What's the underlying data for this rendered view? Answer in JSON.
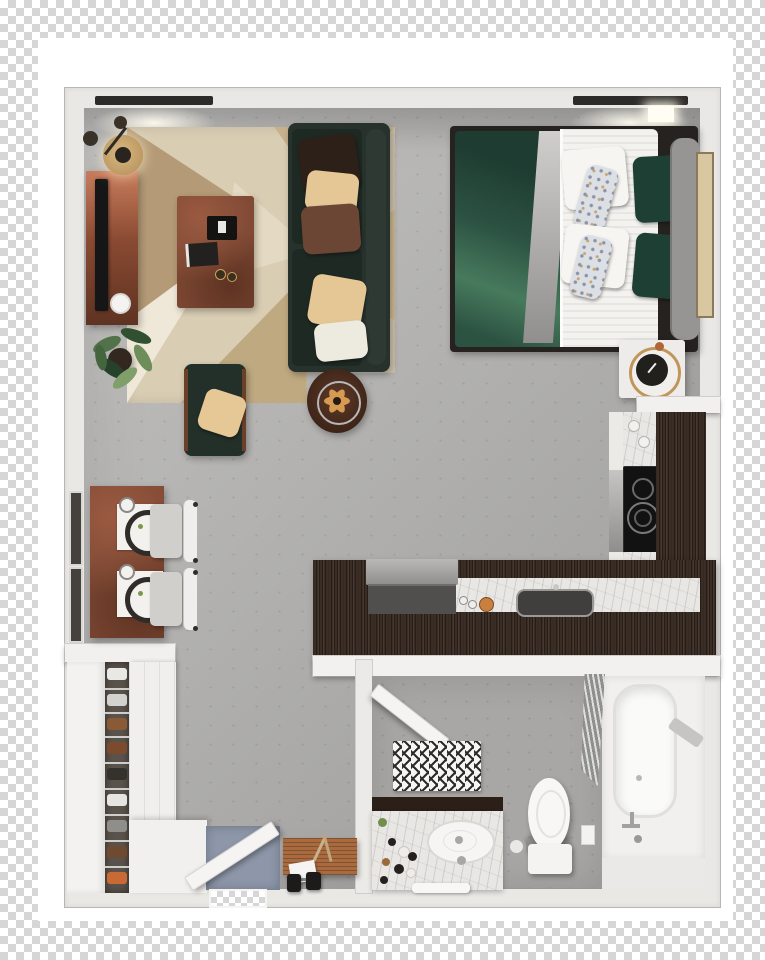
{
  "scene": {
    "kind": "3d-floor-plan-top-view",
    "subject": "studio-apartment-render",
    "background": "transparency-checkerboard",
    "visible_text": ""
  },
  "palette": {
    "checker_gray": "#d6d6d6",
    "photo_background": "#ffffff",
    "wall": "#e9e8e5",
    "floor_concrete": "#aeadab",
    "rug_base": "#d9cdb4",
    "rug_triangle_dark": "#b49a76",
    "sofa_green_black": "#27322d",
    "duvet_green": "#2c5242",
    "pillow_tan": "#e2c795",
    "pillow_rust": "#6c4634",
    "accent_rust_wood": "#7c4733",
    "kitchen_dark_wood": "#3b2d24",
    "marble": "#e9e7e3",
    "cooktop_black": "#121212",
    "entry_mat_blue": "#8d97a9",
    "clock_gold": "#c0965a",
    "bench_wood": "#a86a3e"
  },
  "rooms": {
    "living": {
      "label": "living-area",
      "items": [
        "floor-lamp",
        "tv-console",
        "television",
        "area-rug",
        "coffee-table",
        "sofa",
        "throw-pillows",
        "armchair",
        "side-table",
        "potted-plant"
      ]
    },
    "sleeping": {
      "label": "sleeping-area",
      "items": [
        "double-bed",
        "green-duvet",
        "gray-throw",
        "bed-pillows",
        "headboard",
        "wall-art",
        "nightstand",
        "table-clock"
      ]
    },
    "dining": {
      "label": "dining-nook",
      "items": [
        "dining-table",
        "place-settings",
        "dining-chairs",
        "windows"
      ]
    },
    "kitchen": {
      "label": "kitchen",
      "items": [
        "l-shaped-counter",
        "cooktop",
        "oven",
        "kitchen-sink",
        "copper-pot",
        "countertop-appliance"
      ]
    },
    "bathroom": {
      "label": "bathroom",
      "items": [
        "bathroom-door",
        "bath-mat",
        "toilet",
        "vanity",
        "vanity-sink",
        "shower-curtain",
        "bathtub",
        "tub-faucet"
      ]
    },
    "entry": {
      "label": "entry-closet",
      "items": [
        "shoe-shelf",
        "closet-door",
        "wardrobe",
        "entry-door",
        "door-mat",
        "bench",
        "dumbbells"
      ]
    }
  },
  "items": {
    "sofa": "sofa",
    "rug": "area-rug",
    "coffee_table": "coffee-table",
    "tv_console": "tv-console",
    "tv": "television",
    "floor_lamp": "floor-lamp",
    "armchair": "armchair",
    "side_table": "side-table",
    "plant": "potted-plant",
    "bed": "double-bed",
    "headboard": "headboard",
    "nightstand": "nightstand",
    "clock": "table-clock",
    "wall_art": "wall-art",
    "dining_table": "dining-table",
    "chair": "dining-chair",
    "cooktop": "cooktop",
    "oven": "oven",
    "kitchen_sink": "kitchen-sink",
    "counter": "kitchen-counter",
    "copper_pot": "copper-pot",
    "appliance": "countertop-appliance",
    "bathtub": "bathtub",
    "toilet": "toilet",
    "vanity": "bathroom-vanity",
    "shower_curtain": "shower-curtain",
    "bath_mat": "bath-mat",
    "bathroom_door": "bathroom-door",
    "entry_door": "entry-door",
    "door_mat": "entry-door-mat",
    "bench": "entry-bench",
    "shoe_shelf": "shoe-shelf",
    "wardrobe": "wardrobe",
    "window": "window",
    "dumbbells": "dumbbells"
  }
}
